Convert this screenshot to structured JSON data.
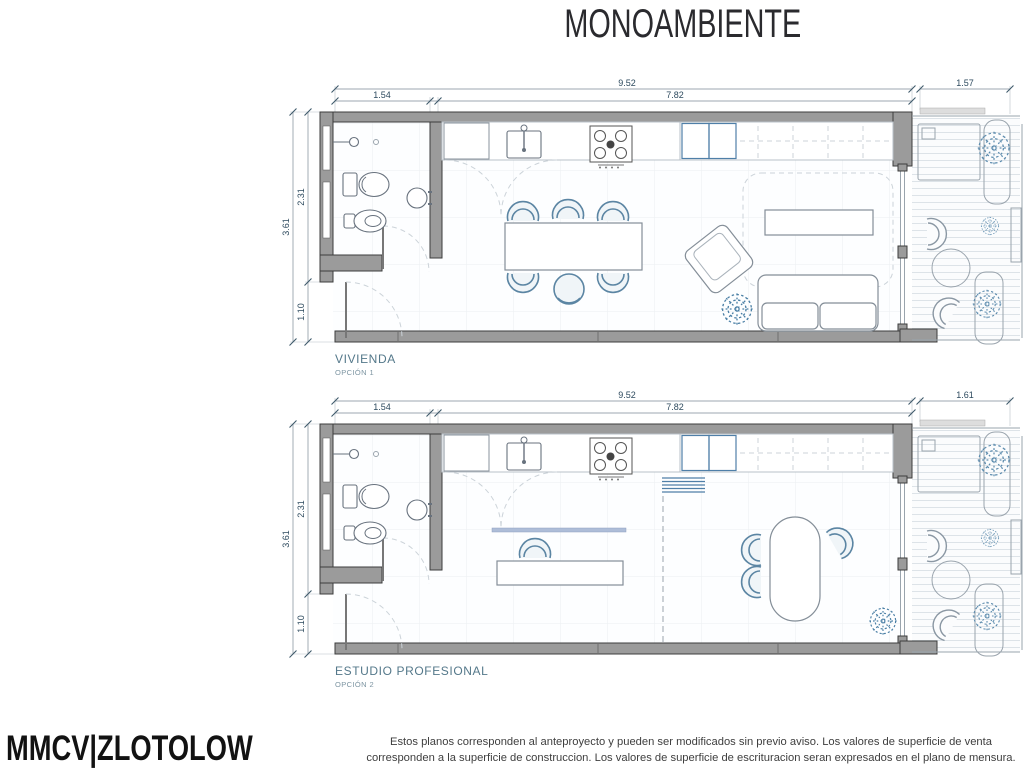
{
  "title": "MONOAMBIENTE",
  "plans": [
    {
      "name": "VIVIENDA",
      "option": "OPCIÓN 1",
      "dims": {
        "total_w": "9.52",
        "bath_w": "1.54",
        "main_w": "7.82",
        "balcony_w": "1.57",
        "total_h": "3.61",
        "bath_h": "2.31",
        "entry_h": "1.10"
      }
    },
    {
      "name": "ESTUDIO PROFESIONAL",
      "option": "OPCIÓN 2",
      "dims": {
        "total_w": "9.52",
        "bath_w": "1.54",
        "main_w": "7.82",
        "balcony_w": "1.61",
        "total_h": "3.61",
        "bath_h": "2.31",
        "entry_h": "1.10"
      }
    }
  ],
  "footer": {
    "logo": "MMCV|ZLOTOLOW",
    "disclaimer_line1": "Estos planos corresponden al anteproyecto y pueden ser modificados sin previo aviso. Los valores de superficie de venta",
    "disclaimer_line2": "corresponden a la superficie de construccion. Los valores de superficie de escrituracion seran expresados en el plano de mensura."
  },
  "colors": {
    "wall_gray": "#9b9b9b",
    "accent_blue": "#5b85a3",
    "plant_blue": "#4a7fa5",
    "label_teal": "#54788a",
    "dim_text": "#2d4a5e"
  }
}
